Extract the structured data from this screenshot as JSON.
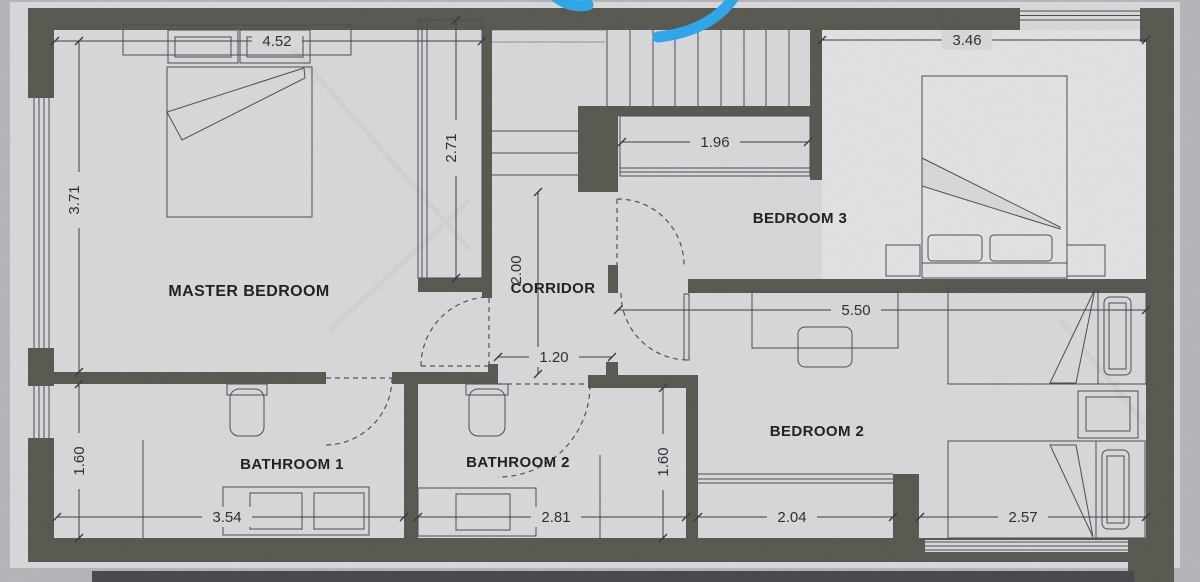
{
  "rooms": {
    "master_bedroom": "MASTER BEDROOM",
    "bedroom_3": "BEDROOM 3",
    "bedroom_2": "BEDROOM 2",
    "corridor": "CORRIDOR",
    "bathroom_1": "BATHROOM 1",
    "bathroom_2": "BATHROOM 2"
  },
  "dimensions": {
    "master_width": "4.52",
    "master_depth": "3.71",
    "master_wardrobe_length": "2.71",
    "corridor_length": "2.00",
    "corridor_width": "1.20",
    "bedroom3_wardrobe_width": "1.96",
    "bedroom3_width": "3.46",
    "bedroom2_width": "5.50",
    "bathroom1_depth": "1.60",
    "bathroom1_width": "3.54",
    "bathroom2_width": "2.81",
    "bathroom2_depth": "1.60",
    "bedroom2_south_west_width": "2.04",
    "bedroom2_south_east_width": "2.57"
  },
  "colors": {
    "paper": "#d7d6d9",
    "scan_background": "#b4b4b8",
    "wall": "#57564f",
    "drawing_line": "#4a4a52",
    "dimension_text": "#2c2c33",
    "label_text": "#1d1d22",
    "marker_blue": "#2ba6ea",
    "page_shadow": "#46464b"
  }
}
